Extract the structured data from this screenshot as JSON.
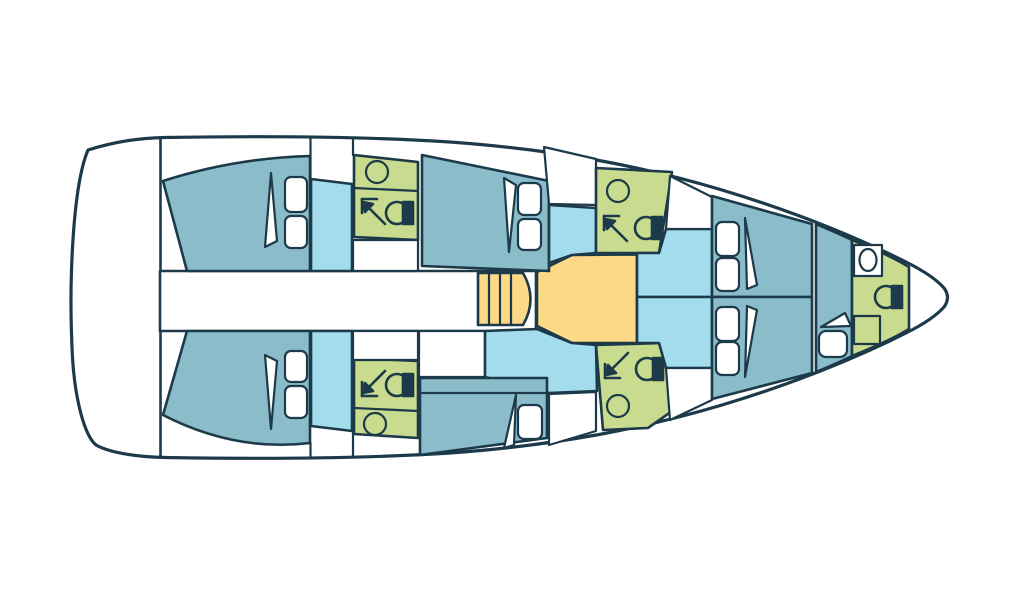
{
  "meta": {
    "title": "Sailing yacht interior deck plan, top-down view, bow pointing right",
    "orientation": "bow-right"
  },
  "colors": {
    "page_bg": "#ffffff",
    "outline": "#1c3a49",
    "deck_white": "#ffffff",
    "cabin_bed": "#8bbcca",
    "cabin_floor": "#a3dcec",
    "wet_room": "#c9db8e",
    "galley": "#fbd987",
    "fixture_white": "#ffffff"
  },
  "legend": {
    "cabin_bed": "teal: berths / bed areas",
    "cabin_floor": "light blue: cabin floors and saloon seating",
    "wet_room": "green: heads (shower, WC, basin)",
    "galley": "orange: galley / companionway area",
    "deck_white": "white: deck, corridors, lockers"
  },
  "rooms": [
    {
      "id": "aft-cabin-port",
      "label": "Aft double cabin (port)"
    },
    {
      "id": "aft-cabin-starboard",
      "label": "Aft double cabin (starboard)"
    },
    {
      "id": "aft-head-port",
      "label": "Aft head (port)"
    },
    {
      "id": "aft-head-starboard",
      "label": "Aft head (starboard)"
    },
    {
      "id": "mid-cabin-port",
      "label": "Midship double cabin (port)"
    },
    {
      "id": "mid-cabin-starboard",
      "label": "Midship single cabin (starboard)"
    },
    {
      "id": "mid-head-port",
      "label": "Midship head (port)"
    },
    {
      "id": "mid-head-starboard",
      "label": "Midship head (starboard)"
    },
    {
      "id": "saloon",
      "label": "Saloon with companionway steps"
    },
    {
      "id": "forward-cabin",
      "label": "Forward V-berth cabin"
    },
    {
      "id": "bow-berth",
      "label": "Bow single berth"
    },
    {
      "id": "bow-head",
      "label": "Bow head"
    }
  ],
  "fixtures": {
    "berth_pillows": 12,
    "toilets": 5,
    "basins": 5,
    "showers": 4,
    "companionway_steps": 4
  }
}
